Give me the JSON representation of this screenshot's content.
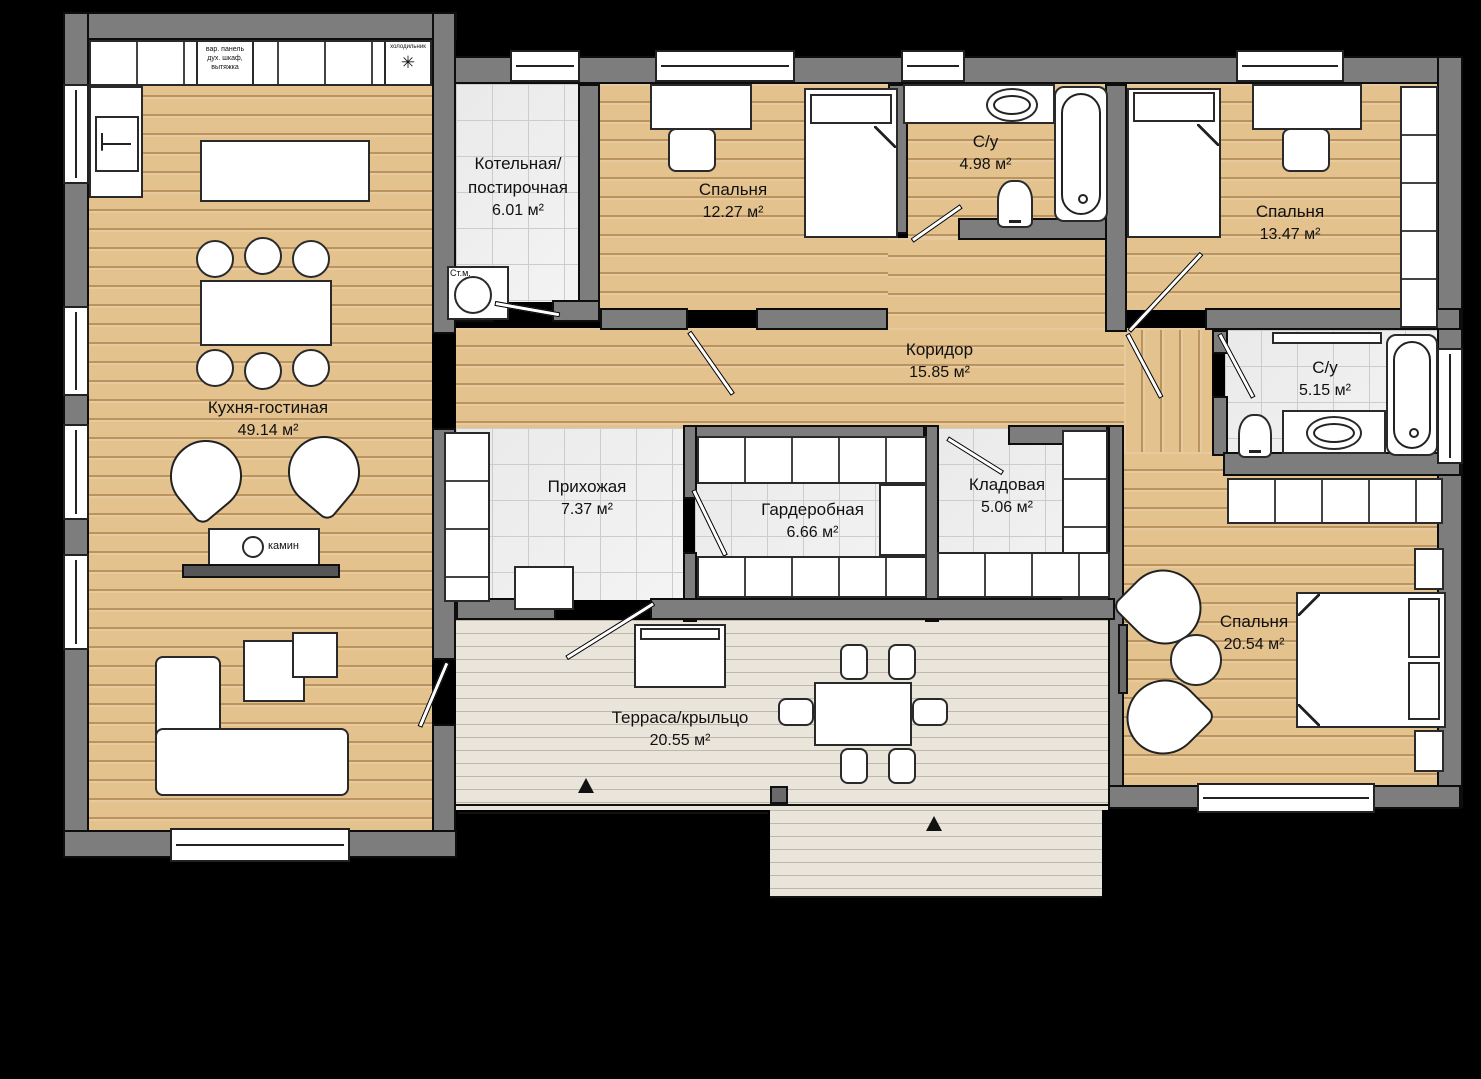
{
  "plan": {
    "rooms": {
      "kitchen_living": {
        "name": "Кухня-гостиная",
        "area": "49.14 м²"
      },
      "boiler": {
        "name_line1": "Котельная/",
        "name_line2": "постирочная",
        "area": "6.01 м²"
      },
      "bedroom_top_left": {
        "name": "Спальня",
        "area": "12.27 м²"
      },
      "bathroom_top": {
        "name": "С/у",
        "area": "4.98 м²"
      },
      "bedroom_top_right": {
        "name": "Спальня",
        "area": "13.47 м²"
      },
      "corridor": {
        "name": "Коридор",
        "area": "15.85 м²"
      },
      "bathroom_right": {
        "name": "С/у",
        "area": "5.15 м²"
      },
      "hallway": {
        "name": "Прихожая",
        "area": "7.37 м²"
      },
      "wardrobe": {
        "name": "Гардеробная",
        "area": "6.66 м²"
      },
      "storage": {
        "name": "Кладовая",
        "area": "5.06 м²"
      },
      "bedroom_bottom_right": {
        "name": "Спальня",
        "area": "20.54 м²"
      },
      "terrace": {
        "name": "Терраса/крыльцо",
        "area": "20.55 м²"
      }
    },
    "annotations": {
      "kitchen_appliances_line1": "вар. панель",
      "kitchen_appliances_line2": "дух. шкаф,",
      "kitchen_appliances_line3": "вытяжка",
      "fridge_label": "холодильник",
      "fridge_symbol": "✳",
      "washer_label": "Ст.м.",
      "fireplace_label": "камин"
    },
    "colors": {
      "background": "#000000",
      "wall": "#7d7d7d",
      "wall_outline": "#0d0d0d",
      "wood": "#e3c28e",
      "deck": "#eae5da",
      "tile": "#f3f3f3",
      "tile_line": "#cccccc",
      "furniture": "#ffffff",
      "furniture_outline": "#2a2a2a",
      "label_text": "#111111"
    }
  }
}
